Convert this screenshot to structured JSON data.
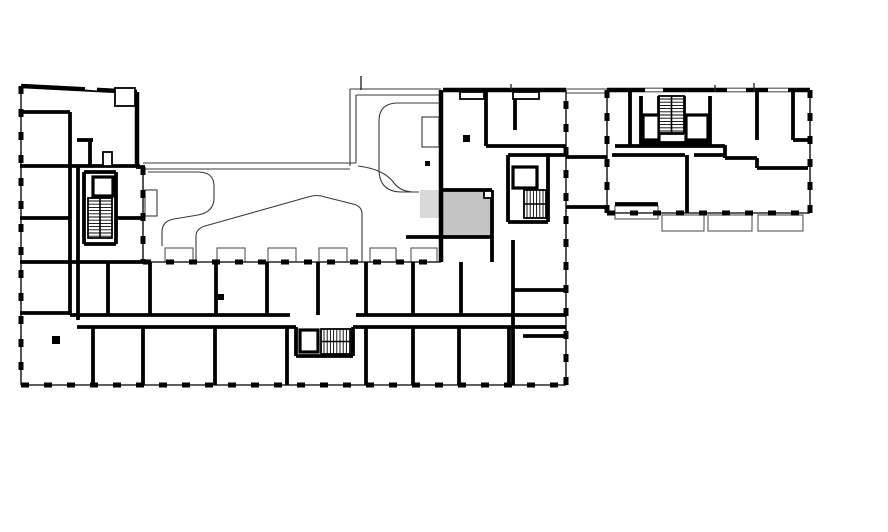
{
  "canvas": {
    "width": 888,
    "height": 532,
    "background": "#ffffff"
  },
  "colors": {
    "wall": "#000000",
    "thin_line": "#3a3a3a",
    "ext_base": "#2a2a2a",
    "balcony_line": "#555555",
    "highlight_unit": "#c4c4c4",
    "highlight_balcony": "#d9d9d9",
    "white": "#ffffff"
  },
  "plan": {
    "highlight": {
      "unit": [
        441,
        190,
        51,
        48
      ],
      "balcony": [
        420,
        190,
        20,
        28
      ]
    },
    "ext_dashed": [
      [
        21,
        86,
        21,
        385
      ],
      [
        21,
        385,
        566,
        385
      ],
      [
        566,
        385,
        566,
        90
      ],
      [
        143,
        167,
        143,
        262
      ],
      [
        143,
        262,
        441,
        262
      ],
      [
        810,
        90,
        810,
        213
      ],
      [
        607,
        213,
        810,
        213
      ],
      [
        607,
        90,
        607,
        213
      ]
    ],
    "ext_solid": [
      [
        21,
        86,
        137,
        92
      ],
      [
        443,
        90,
        566,
        90
      ],
      [
        607,
        90,
        810,
        90
      ],
      [
        137,
        92,
        137,
        167
      ],
      [
        441,
        90,
        441,
        262
      ]
    ],
    "walls": [
      [
        20,
        112,
        70,
        112
      ],
      [
        70,
        112,
        70,
        315
      ],
      [
        78,
        167,
        78,
        320
      ],
      [
        20,
        166,
        140,
        166
      ],
      [
        77,
        140,
        93,
        140
      ],
      [
        90,
        140,
        90,
        166
      ],
      [
        20,
        218,
        70,
        218
      ],
      [
        20,
        262,
        143,
        262
      ],
      [
        20,
        313,
        70,
        313
      ],
      [
        116,
        218,
        143,
        218
      ],
      [
        136,
        167,
        145,
        167
      ],
      [
        84,
        172,
        116,
        172
      ],
      [
        84,
        172,
        84,
        244
      ],
      [
        116,
        172,
        116,
        244
      ],
      [
        84,
        244,
        116,
        244
      ],
      [
        70,
        315,
        290,
        315
      ],
      [
        356,
        315,
        566,
        315
      ],
      [
        77,
        327,
        296,
        327
      ],
      [
        353,
        327,
        566,
        327
      ],
      [
        93,
        327,
        93,
        385
      ],
      [
        108,
        262,
        108,
        315
      ],
      [
        150,
        262,
        150,
        315
      ],
      [
        216,
        262,
        216,
        315
      ],
      [
        267,
        262,
        267,
        315
      ],
      [
        318,
        262,
        318,
        315
      ],
      [
        366,
        262,
        366,
        315
      ],
      [
        413,
        262,
        413,
        315
      ],
      [
        461,
        262,
        461,
        315
      ],
      [
        143,
        327,
        143,
        385
      ],
      [
        215,
        327,
        215,
        385
      ],
      [
        287,
        327,
        287,
        385
      ],
      [
        366,
        327,
        366,
        385
      ],
      [
        413,
        327,
        413,
        385
      ],
      [
        459,
        327,
        459,
        385
      ],
      [
        509,
        327,
        509,
        385
      ],
      [
        296,
        327,
        296,
        356
      ],
      [
        296,
        356,
        353,
        356
      ],
      [
        353,
        327,
        353,
        356
      ],
      [
        513,
        240,
        513,
        385
      ],
      [
        513,
        290,
        566,
        290
      ],
      [
        523,
        336,
        566,
        336
      ],
      [
        492,
        237,
        492,
        262
      ],
      [
        486,
        90,
        486,
        146
      ],
      [
        515,
        90,
        515,
        130
      ],
      [
        486,
        146,
        566,
        146
      ],
      [
        508,
        155,
        566,
        155
      ],
      [
        508,
        155,
        508,
        222
      ],
      [
        508,
        222,
        548,
        222
      ],
      [
        548,
        155,
        548,
        222
      ],
      [
        443,
        190,
        492,
        190
      ],
      [
        492,
        190,
        492,
        238
      ],
      [
        406,
        237,
        493,
        237
      ],
      [
        566,
        157,
        607,
        157
      ],
      [
        566,
        207,
        607,
        207
      ],
      [
        630,
        90,
        630,
        146
      ],
      [
        641,
        96,
        641,
        146
      ],
      [
        710,
        96,
        710,
        146
      ],
      [
        641,
        143,
        710,
        143
      ],
      [
        659,
        96,
        659,
        133
      ],
      [
        684,
        96,
        684,
        133
      ],
      [
        659,
        133,
        684,
        133
      ],
      [
        757,
        90,
        757,
        140
      ],
      [
        793,
        92,
        793,
        140
      ],
      [
        793,
        140,
        808,
        140
      ],
      [
        687,
        155,
        687,
        213
      ],
      [
        615,
        146,
        725,
        146
      ],
      [
        612,
        155,
        685,
        155
      ],
      [
        694,
        155,
        725,
        155
      ],
      [
        725,
        145,
        725,
        158
      ],
      [
        725,
        158,
        757,
        158
      ],
      [
        757,
        158,
        757,
        168
      ],
      [
        757,
        168,
        808,
        168
      ],
      [
        615,
        204,
        658,
        204
      ]
    ],
    "thin_lines": [
      [
        350,
        89,
        350,
        166
      ],
      [
        356,
        95,
        356,
        163
      ],
      [
        143,
        163,
        356,
        163
      ],
      [
        143,
        169,
        350,
        169
      ],
      [
        350,
        89,
        441,
        89
      ],
      [
        356,
        95,
        441,
        95
      ],
      [
        566,
        89,
        607,
        89
      ],
      [
        566,
        93,
        607,
        93
      ]
    ],
    "curves": [
      "M148,172 H198 Q214,172 214,186 V198 Q214,212 198,215 L174,219 Q162,221 162,232 V246",
      "M196,262 V236 Q196,229 205,226 L308,197 Q317,194 325,197 L353,204 Q362,206 362,214 V262",
      "M441,103 H398 Q379,103 379,121 V169 Q379,192 402,192 H419",
      "M358,166 Q384,169 394,183 Q400,191 412,192"
    ],
    "balconies": [
      [
        165,
        248,
        28,
        14
      ],
      [
        217,
        248,
        28,
        14
      ],
      [
        268,
        248,
        28,
        14
      ],
      [
        319,
        248,
        28,
        14
      ],
      [
        370,
        248,
        26,
        14
      ],
      [
        411,
        248,
        26,
        14
      ],
      [
        615,
        206,
        43,
        13
      ],
      [
        662,
        215,
        42,
        16
      ],
      [
        708,
        215,
        44,
        16
      ],
      [
        758,
        215,
        45,
        16
      ]
    ],
    "thin_rects": [
      [
        422,
        117,
        17,
        30
      ],
      [
        145,
        190,
        12,
        26
      ]
    ],
    "medium_rects": [
      [
        115,
        88,
        20,
        18
      ],
      [
        460,
        92,
        24,
        7
      ],
      [
        513,
        92,
        26,
        7
      ],
      [
        484,
        191,
        8,
        7
      ],
      [
        103,
        152,
        9,
        14
      ]
    ],
    "columns": [
      [
        463,
        135,
        7,
        7
      ],
      [
        52,
        336,
        8,
        8
      ],
      [
        218,
        294,
        6,
        6
      ],
      [
        425,
        161,
        5,
        5
      ]
    ],
    "elevators": [
      [
        93,
        177,
        20,
        19
      ],
      [
        300,
        330,
        18,
        22
      ],
      [
        513,
        167,
        24,
        21
      ],
      [
        643,
        115,
        16,
        25
      ],
      [
        686,
        115,
        22,
        25
      ]
    ],
    "stairs": [
      {
        "x": 88,
        "y": 198,
        "w": 24,
        "h": 40,
        "dir": "h"
      },
      {
        "x": 321,
        "y": 329,
        "w": 30,
        "h": 25,
        "dir": "v"
      },
      {
        "x": 524,
        "y": 190,
        "w": 22,
        "h": 28,
        "dir": "v"
      },
      {
        "x": 659,
        "y": 96,
        "w": 25,
        "h": 37,
        "dir": "h"
      }
    ],
    "white_slots": [
      [
        85,
        88,
        97,
        89
      ],
      [
        645,
        90,
        663,
        90
      ],
      [
        727,
        90,
        746,
        90
      ],
      [
        768,
        90,
        788,
        90
      ]
    ],
    "stubs": [
      [
        361,
        76,
        361,
        90
      ],
      [
        511,
        84,
        511,
        90
      ],
      [
        715,
        85,
        715,
        92
      ],
      [
        754,
        83,
        754,
        92
      ]
    ]
  }
}
